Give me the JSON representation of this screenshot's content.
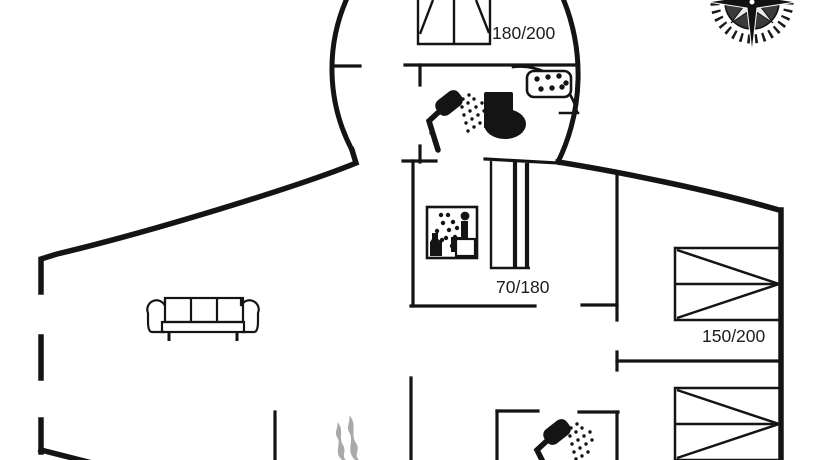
{
  "meta": {
    "type": "floor-plan",
    "description": "black-line holiday home floor plan with round tower room, top partially cropped"
  },
  "labels": {
    "tower_bed": "180/200",
    "junior_bed": "70/180",
    "right_bed": "150/200"
  },
  "icons": {
    "compass": "compass-rose-icon",
    "shower_bathroom": "shower-icon",
    "shower_bottom": "shower-icon",
    "toilet": "toilet-icon",
    "sink": "sink-icon",
    "sauna": "sauna-icon",
    "sofa": "sofa-icon",
    "fireplace": "fireplace-flames-icon",
    "double_bed_tower": "double-bed-icon",
    "junior_bed": "junior-bed-icon",
    "double_bed_right_1": "double-bed-icon",
    "double_bed_right_2": "double-bed-icon"
  },
  "colors": {
    "wall": "#141414",
    "background": "#ffffff",
    "flame_gray": "#a9a9a9",
    "compass_disc": "#3a3a3a"
  }
}
